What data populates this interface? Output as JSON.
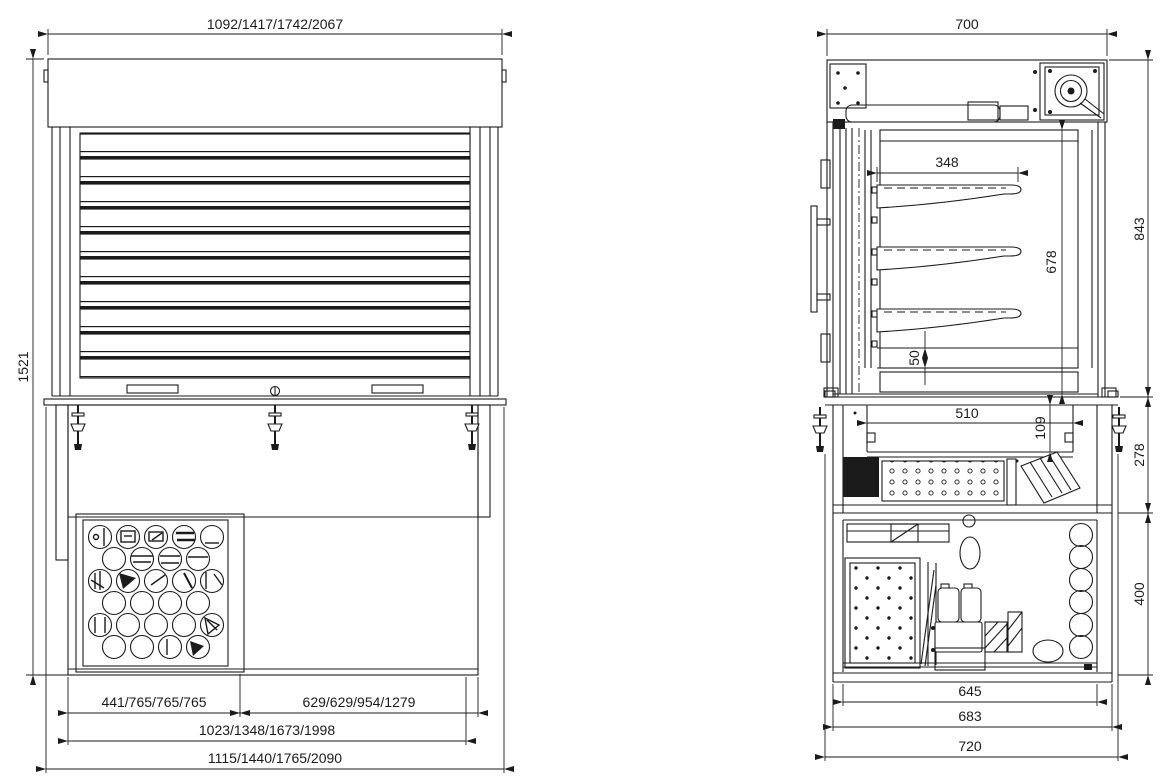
{
  "drawing": {
    "background": "#ffffff",
    "line_color": "#1b1b1b",
    "front_view": {
      "label": "front-elevation",
      "dims": {
        "width_top": "1092/1417/1742/2067",
        "height_total": "1521",
        "bottom_vent_section": "441/765/765/765",
        "bottom_right_section": "629/629/954/1279",
        "bottom_inner_width": "1023/1348/1673/1998",
        "bottom_overall_width": "1115/1440/1765/2090"
      }
    },
    "side_view": {
      "label": "side-section",
      "dims": {
        "width_top": "700",
        "shelf_depth": "348",
        "interior_height": "678",
        "upper_height": "843",
        "floor_gap": "50",
        "well_width": "510",
        "well_depth": "109",
        "counter_height": "278",
        "base_height": "400",
        "base_inner_width": "645",
        "base_mid_width": "683",
        "base_overall_width": "720"
      }
    }
  }
}
